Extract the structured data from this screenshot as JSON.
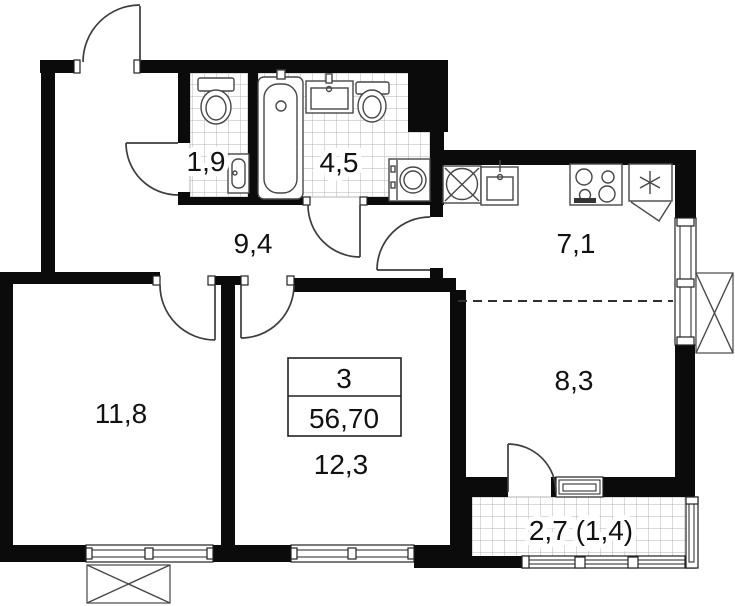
{
  "plan": {
    "type": "apartment-floor-plan",
    "rooms": [
      {
        "name": "wc",
        "area": "1,9"
      },
      {
        "name": "bathroom",
        "area": "4,5"
      },
      {
        "name": "hallway",
        "area": "9,4"
      },
      {
        "name": "kitchen",
        "area": "7,1"
      },
      {
        "name": "bedroom-1",
        "area": "11,8"
      },
      {
        "name": "living-room",
        "area": "8,3"
      },
      {
        "name": "bedroom-2",
        "area": "12,3"
      },
      {
        "name": "balcony",
        "area": "2,7 (1,4)"
      }
    ],
    "info_box": {
      "rooms_count": "3",
      "total_area": "56,70"
    },
    "colors": {
      "wall": "#0b0b0b",
      "background": "#ffffff",
      "fixture_line": "#474747",
      "tile_line": "#b5b5b5"
    }
  }
}
